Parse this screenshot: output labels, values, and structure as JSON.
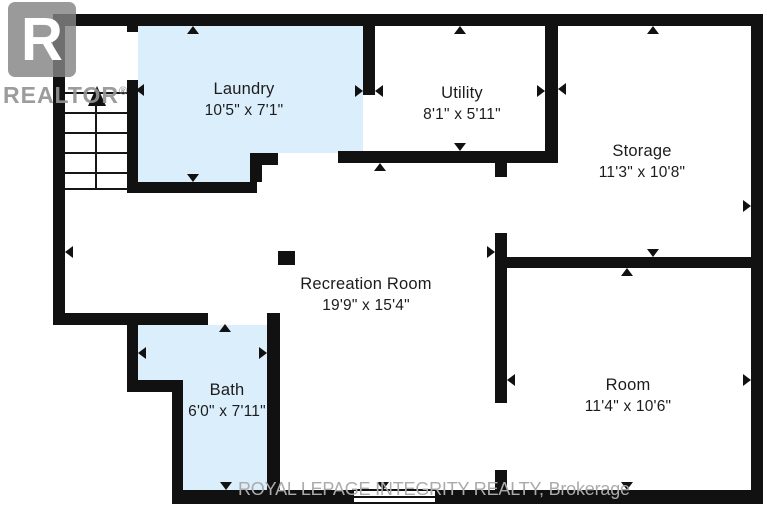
{
  "branding": {
    "realtor_logo": {
      "letter": "R",
      "label": "REALTOR",
      "registered_mark": "®"
    },
    "watermark": "ROYAL LEPAGE INTEGRITY REALTY, Brokerage"
  },
  "colors": {
    "room_highlight": "#dbeefb",
    "wall": "#111111",
    "text": "#1c1c1c",
    "watermark_gray": "#ababab",
    "logo_gray": "#9a9a9a"
  },
  "rooms": [
    {
      "id": "laundry",
      "name": "Laundry",
      "dimensions": "10'5\" x 7'1\"",
      "highlighted": true
    },
    {
      "id": "utility",
      "name": "Utility",
      "dimensions": "8'1\" x 5'11\"",
      "highlighted": false
    },
    {
      "id": "storage",
      "name": "Storage",
      "dimensions": "11'3\" x 10'8\"",
      "highlighted": false
    },
    {
      "id": "recreation",
      "name": "Recreation Room",
      "dimensions": "19'9\" x 15'4\"",
      "highlighted": false
    },
    {
      "id": "bath",
      "name": "Bath",
      "dimensions": "6'0\" x 7'11\"",
      "highlighted": true
    },
    {
      "id": "room",
      "name": "Room",
      "dimensions": "11'4\" x 10'6\"",
      "highlighted": false
    }
  ]
}
